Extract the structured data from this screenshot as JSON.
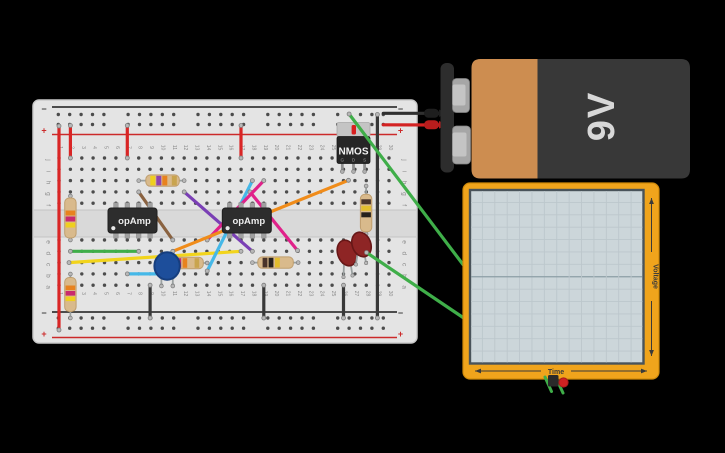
{
  "canvas": {
    "width": 725,
    "height": 453,
    "background": "#000000"
  },
  "breadboard": {
    "x": 33,
    "y": 100,
    "width": 384,
    "height": 243,
    "body_color": "#e4e4e4",
    "edge_color": "#c9c9c9",
    "channel_color": "#d9d9d9",
    "hole_color": "#4c4c4c",
    "rail": {
      "minus_label": "−",
      "plus_label": "+",
      "minus_color": "#3a3a3a",
      "plus_color": "#cc2a2a"
    },
    "col_numbers": [
      "1",
      "2",
      "3",
      "4",
      "5",
      "6",
      "7",
      "8",
      "9",
      "10",
      "11",
      "12",
      "13",
      "14",
      "15",
      "16",
      "17",
      "18",
      "19",
      "20",
      "21",
      "22",
      "23",
      "24",
      "25",
      "26",
      "27",
      "28",
      "29",
      "30"
    ],
    "row_letters_top": [
      "j",
      "i",
      "h",
      "g",
      "f"
    ],
    "row_letters_bottom": [
      "e",
      "d",
      "c",
      "b",
      "a"
    ]
  },
  "wires": [
    {
      "name": "wire-red-left-rail",
      "color": "#d92525",
      "x1": 59,
      "y1": 126,
      "x2": 59,
      "y2": 330,
      "dot1": true,
      "dot2": true
    },
    {
      "name": "wire-red-col2",
      "color": "#d92525",
      "x1": 70.4,
      "y1": 125.5,
      "x2": 70.4,
      "y2": 158,
      "dot1": true,
      "dot2": true
    },
    {
      "name": "wire-red-col7",
      "color": "#d92525",
      "x1": 127.3,
      "y1": 125.5,
      "x2": 127.3,
      "y2": 158,
      "dot1": true,
      "dot2": true
    },
    {
      "name": "wire-red-col17",
      "color": "#d92525",
      "x1": 241,
      "y1": 125.5,
      "x2": 241,
      "y2": 158,
      "dot1": true,
      "dot2": true
    },
    {
      "name": "wire-black-col29",
      "color": "#383838",
      "x1": 377.4,
      "y1": 114.5,
      "x2": 377.4,
      "y2": 318,
      "dot1": true,
      "dot2": true
    },
    {
      "name": "wire-black-col9",
      "color": "#383838",
      "x1": 150.1,
      "y1": 285.2,
      "x2": 150.1,
      "y2": 318,
      "dot1": true,
      "dot2": true
    },
    {
      "name": "wire-black-col19",
      "color": "#383838",
      "x1": 263.8,
      "y1": 285.2,
      "x2": 263.8,
      "y2": 318,
      "dot1": true,
      "dot2": true
    },
    {
      "name": "wire-black-col26",
      "color": "#383838",
      "x1": 343.5,
      "y1": 285.2,
      "x2": 343.5,
      "y2": 318,
      "dot1": true,
      "dot2": true
    },
    {
      "name": "wire-green-rowd",
      "color": "#3fae49",
      "x1": 70.4,
      "y1": 251.3,
      "x2": 138.7,
      "y2": 251.3,
      "dot1": true,
      "dot2": true
    },
    {
      "name": "wire-yellow-long",
      "color": "#f2d41c",
      "x1": 69,
      "y1": 262.6,
      "x2": 241,
      "y2": 251.3,
      "dot1": true,
      "dot2": true
    },
    {
      "name": "wire-cyan-rowb",
      "color": "#45b8e8",
      "x1": 127.3,
      "y1": 273.9,
      "x2": 172.8,
      "y2": 273.9,
      "dot1": true,
      "dot2": true
    },
    {
      "name": "wire-brown-diag",
      "color": "#8a6240",
      "x1": 138.7,
      "y1": 191.9,
      "x2": 172.8,
      "y2": 240,
      "dot1": true,
      "dot2": true
    },
    {
      "name": "wire-purple-diag",
      "color": "#7a3fb5",
      "x1": 184.2,
      "y1": 191.9,
      "x2": 252.4,
      "y2": 251.3,
      "dot1": true,
      "dot2": true
    },
    {
      "name": "wire-cyan-diag",
      "color": "#45b8e8",
      "x1": 252.4,
      "y1": 180.6,
      "x2": 207.2,
      "y2": 271,
      "dot1": true,
      "dot2": true
    },
    {
      "name": "wire-magenta-a",
      "color": "#e0218a",
      "x1": 250,
      "y1": 191.9,
      "x2": 297.5,
      "y2": 250.5,
      "dot1": true,
      "dot2": true
    },
    {
      "name": "wire-magenta-b",
      "color": "#e0218a",
      "x1": 263.8,
      "y1": 180.6,
      "x2": 207.2,
      "y2": 240,
      "dot1": true,
      "dot2": true
    },
    {
      "name": "wire-orange-diag",
      "color": "#f08c1a",
      "x1": 172.8,
      "y1": 251.3,
      "x2": 348.5,
      "y2": 180.3,
      "dot1": true,
      "dot2": true
    },
    {
      "name": "wire-green-to-scope-top",
      "color": "#3fae49",
      "x1": 349.1,
      "y1": 114,
      "x2": 463,
      "y2": 264.5,
      "dot1": true,
      "dot2": false
    },
    {
      "name": "wire-green-to-scope-bottom",
      "color": "#3fae49",
      "x1": 366.5,
      "y1": 252.5,
      "x2": 463,
      "y2": 317.5,
      "dot1": true,
      "dot2": false
    }
  ],
  "components": {
    "opamp1": {
      "label": "opAmp",
      "pin_x": [
        115.9,
        127.3,
        138.7,
        150.1
      ],
      "body": {
        "x": 108,
        "y": 208,
        "w": 49,
        "h": 25
      }
    },
    "opamp2": {
      "label": "opAmp",
      "pin_x": [
        229.7,
        241,
        252.4,
        263.8
      ],
      "body": {
        "x": 222.3,
        "y": 208,
        "w": 49,
        "h": 25
      }
    },
    "nmos": {
      "label": "NMOS",
      "pin_labels": [
        "G",
        "D",
        "S"
      ],
      "pin_x": [
        342.3,
        353.5,
        364.6
      ],
      "tab_color": "#c4c4c4",
      "body_color": "#262626",
      "mark_color": "#d81f1f"
    },
    "resistor_body_color": "#d9ba8c",
    "resistor_edge_color": "#bf9e6e",
    "resistors": [
      {
        "name": "resistor-col2-upper",
        "vert": true,
        "lx": 70.4,
        "l1": 196,
        "l2": 240,
        "body": [
          64.7,
          198,
          11.4,
          40
        ],
        "bands": [
          [
            210.5,
            "#e8821e"
          ],
          [
            216.5,
            "#c92a6d"
          ],
          [
            222.5,
            "#efcf1e"
          ]
        ],
        "bt": 5
      },
      {
        "name": "resistor-col2-lower",
        "vert": true,
        "lx": 70.4,
        "l1": 274,
        "l2": 318,
        "body": [
          64.7,
          277.5,
          11.4,
          34
        ],
        "bands": [
          [
            285.5,
            "#e8821e"
          ],
          [
            291,
            "#c92a6d"
          ],
          [
            296.5,
            "#efcf1e"
          ]
        ],
        "bt": 4.6
      },
      {
        "name": "resistor-rowh",
        "vert": false,
        "ly": 180.6,
        "l1": 138.7,
        "l2": 184.2,
        "body": [
          145.8,
          174.9,
          33.5,
          11.4
        ],
        "bands": [
          [
            150.3,
            "#efcf1e"
          ],
          [
            156.3,
            "#8e44ad"
          ],
          [
            162.3,
            "#e8821e"
          ],
          [
            171.8,
            "#c9a44e"
          ]
        ],
        "bt": 5
      },
      {
        "name": "resistor-rowc-mid",
        "vert": false,
        "ly": 263,
        "l1": 164.5,
        "l2": 207.2,
        "body": [
          171.8,
          257.3,
          31.5,
          11.4
        ],
        "bands": [
          [
            176.6,
            "#c92a6d"
          ],
          [
            182.6,
            "#e8821e"
          ],
          [
            194.6,
            "#c9a44e"
          ]
        ],
        "bt": 4.6
      },
      {
        "name": "resistor-rowc-right",
        "vert": false,
        "ly": 262.6,
        "l1": 252.4,
        "l2": 298.2,
        "body": [
          257.8,
          256.9,
          35.5,
          11.4
        ],
        "bands": [
          [
            262.6,
            "#4a342a"
          ],
          [
            268.6,
            "#26211d"
          ],
          [
            275,
            "#e2bd2e"
          ]
        ],
        "bt": 4.8
      },
      {
        "name": "resistor-col28",
        "vert": true,
        "lx": 366.1,
        "l1": 186,
        "l2": 234,
        "body": [
          360.4,
          194.3,
          11.4,
          37.5
        ],
        "bands": [
          [
            199.3,
            "#4a342a"
          ],
          [
            205.8,
            "#e2bd2e"
          ],
          [
            212.3,
            "#26211d"
          ]
        ],
        "bt": 5
      }
    ],
    "capacitor": {
      "cx": 167.1,
      "cy": 266,
      "r": 13.2,
      "color": "#1d4e9b",
      "edge": "#163e7e",
      "legs": [
        [
          161.4,
          266,
          161.4,
          286
        ],
        [
          172.8,
          266,
          172.8,
          286
        ]
      ]
    },
    "led_color": "#8e2525",
    "led_edge": "#671717",
    "leds": [
      {
        "name": "led-1",
        "cx": 347,
        "cy": 253,
        "rx": 9.3,
        "ry": 13.2,
        "rot": -20,
        "legs": [
          [
            344,
            263,
            343.5,
            277
          ],
          [
            350.5,
            263,
            352.5,
            275.5
          ]
        ]
      },
      {
        "name": "led-2",
        "cx": 361.5,
        "cy": 244.5,
        "rx": 9.3,
        "ry": 12.6,
        "rot": -20,
        "legs": [
          [
            357.5,
            254,
            355.9,
            264.5
          ],
          [
            364.5,
            254,
            366.1,
            263
          ]
        ]
      }
    ]
  },
  "battery": {
    "label": "9V",
    "cap_color": "#2d2d2d",
    "terminal_color": "#a6a6a6",
    "terminal_hi": "#c4c4c4",
    "stripe_color": "#cd8d50",
    "body_color": "#383838",
    "text_color": "#d8d8d8",
    "neg_wire_color": "#2f2f2f",
    "pos_wire_color": "#d32222"
  },
  "scope": {
    "xlabel": "Time",
    "ylabel": "Voltage",
    "frame_color": "#f0a41c",
    "frame_edge": "#d08a0a",
    "screen_color": "#ccd6da",
    "screen_edge": "#49535a",
    "grid_color": "#bcc7cc",
    "grid_center_color": "#8d9ea6",
    "probe_neg_color": "#2a2a2a",
    "probe_pos_color": "#cf2222",
    "probe_wire_color": "#3fae49"
  }
}
